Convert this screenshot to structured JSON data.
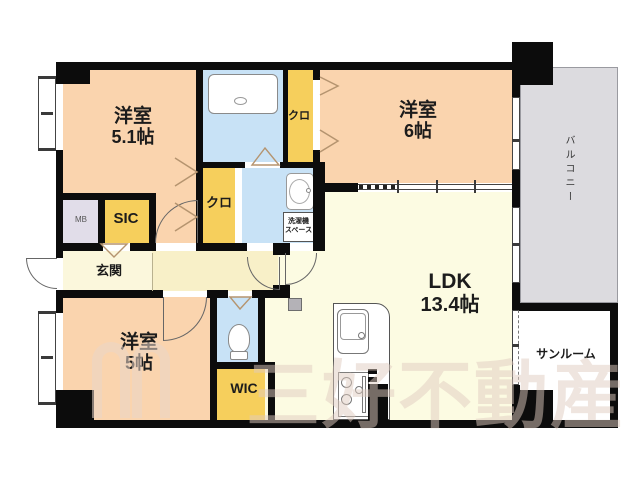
{
  "plan": {
    "rooms": {
      "bedroom_a": {
        "name": "洋室",
        "size": "5.1帖"
      },
      "bedroom_b": {
        "name": "洋室",
        "size": "6帖"
      },
      "bedroom_c": {
        "name": "洋室",
        "size": "5帖"
      },
      "ldk": {
        "name": "LDK",
        "size": "13.4帖"
      },
      "entrance": {
        "label": "玄関"
      },
      "closet_top": {
        "label": "クロ"
      },
      "closet_mid": {
        "label": "クロ"
      },
      "shoe_closet": {
        "label": "SIC"
      },
      "walk_in_closet": {
        "label": "WIC"
      },
      "meter_box": {
        "label": "MB"
      },
      "balcony": {
        "label": "バルコニー"
      },
      "sunroom": {
        "label": "サンルーム"
      },
      "laundry_space": {
        "line1": "洗濯機",
        "line2": "スペース"
      }
    },
    "watermark": {
      "text": "三好不動産"
    },
    "colors": {
      "wall": "#0c0c0c",
      "bedroom_floor": "#fad4ae",
      "ldk_floor": "#fcfbe2",
      "hall_floor": "#f8f0c8",
      "closet_floor": "#f6cf5c",
      "wet_area_floor": "#c8e2f6",
      "meter_box_floor": "#e1dde9",
      "balcony_floor": "#dcdbdf",
      "door_symbol": "#b5946f"
    }
  }
}
